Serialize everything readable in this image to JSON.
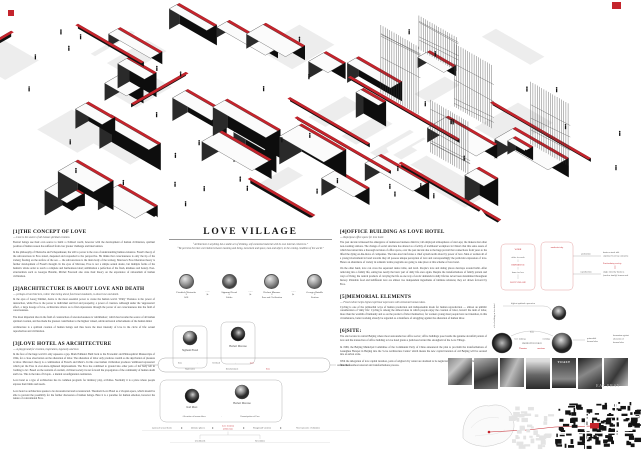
{
  "board": {
    "title": "LOVE VILLAGE",
    "quote_1": "“Architecture is anything but a stable act of thinking, self-contained material with its own internal coherence.”",
    "quote_2": "“We perceive the inter-correlation between meaning and being, movement and space, man and object, in the coming condition of the world.”"
  },
  "left_column": {
    "sections": [
      {
        "heading": "[1]THE CONCEPT OF LOVE",
        "subtitle": "--- Love is the source of all human spiritual creation.",
        "paragraphs": [
          "Eternal beings use their own source to build a civilized world, however with the development of human civilization, spiritual position of human reason has suffered from ever greater challenge and intervention.",
          "In the philosophy of Nietzsche and Schopenhauer, the will to power is the core of understanding human existence. Freud's theory of the subconscious in Eros stated, deepened and responded to the perspective. He thinks that consciousness is only the tip of the iceberg floating on the surface of the sea — the subconscious is the main body of the iceberg. Marcuse's Eros liberation theory is further development of Freud's thought. In the eyes of Marcuse, Eros is not a simple sexual desire, but multiple forms of the human's whole order to reach a complete and harmonious ideal; sublimation a perfection of the flesh, kindness and beauty. Post-structuralists such as Georges Bataille, Michel Foucault also state their theory on the experience of rationalism of human civilization."
        ]
      },
      {
        "heading": "[2]ARCHITECTURE IS ABOUT LOVE AND DEATH",
        "subtitle": "--- perhaps all architecture, rather than being about functional standards, is about love and death.",
        "paragraphs": [
          "In the eyes of Georg Simmel, desire is the most essential power to create the human world. 'Wally' Thanatos is the power of destruction, while Eros is the power to individual survival and prosperity, a power of creation. Although under the 'suppression' effect, a large dosage of love, architecture allows us to find expressions through the power of our consciousness into the field of consciousness.",
          "The most important idea in the field of construction of unconsciousness is 'sublimation', which has become the source of all human spiritual creation, and has made the greatest contribution to the highest valued, subtle universal achievements of the human mind.",
          "Architecture is a spiritual creation of human beings and thus bears the most intensity of love in the circle of life: sexual reproduction and civilization."
        ]
      },
      {
        "heading": "[3]LOVE HOTEL AS ARCHITECTURE",
        "subtitle": "--- A playground for creation, inspiration, ingenuity and love.",
        "paragraphs": [
          "In the face of the huge world it only squeezes a gap. Mark Edmund. Built back to the Economic and Philosophical Manuscripts of 1844, for a close observation on the alienation of labor. The alienation of labor only produces wealth so the deprivation of pleasure is labor. Marcuse's theory is a combination of Freud's and Marx's. In this case human civilization produces 'additional repression' which put the Eros in ever-more-tightened imprisonment. The Eros has combined to ground into other parts of the body left in 'nothing to be'. Based on the restraint of erotism, civilized society its net forward the propagation of the community of human death and love. This is the idea of Utopia - a mental reconfiguration realization.",
          "Love hotel as a type of architecture has its common program: for intimacy play, activities. Normally it is a place where people express their limits and needs.",
          "Love hotel as architecture speaks to be deconstructed and reconstructed. Threshold Love Hotel as a Utopian space, which should be able to prevent the possibility for the further discussion of human beings. Here it is a paradise for human emotion, however the nature of conventional Eros."
        ]
      }
    ]
  },
  "right_column": {
    "sections": [
      {
        "heading": "[4]OFFICE BUILDING AS LOVE HOTEL",
        "subtitle": "--- Repurpose office space for love hotel.",
        "paragraphs": [
          "The past decade witnessed the emergence of numerous business districts; tall employed atmospheres of start-ups; the makers met other non-working stations. The change of social structure has altered as a facility of traditional workplace in China's that this sales assets of which has turned into a thorough revision of office space, over the past decade due to the huge prevail that connections from years to the lifted the dying on-the-move of companies. The idea-less brief states a chief system north about by power of love. Men or women all of a young involvement in bond towards they all possess unique perception of love and correspondingly the particular expression of love. Hence an abundance of variety in romantic terms programs are going to take place at this scheme of love hotel.",
          "On the other hand, love can cross the separated desire table, and level. People's love and dating places develops around habit. After removing into a family life, eating has nearly the basic part of daily life once again. Despite the transformations of family pattern and ways of living, the central products of carrying the life as one way of erotic demands in daily life has never been determined throughout history. Palatable food and indifferent love are almost two independent ingredients of intimate relations; they act drawn forward by Eros."
        ]
      },
      {
        "heading": "[5]MEMORIAL ELEMENTS",
        "subtitle": "--- Fixed culture helps highest spiritual expression with elemental human ideas.",
        "paragraphs": [
          "Cycling is one of the primordial ways of human production and indispensable mode for human reproduction — almost an umbilic consideration of 'daily life'. Cycling is among the almost ideas in which people enjoy the creation of labor, haven't the item of labor, more than the warmth of humanity and so on the product of labor themselves; for workers young most people have not intention, in this circumstance, better working already be regarded as a manifesto of struggling against the alienation of human labor."
        ]
      },
      {
        "heading": "[6]SITE:",
        "subtitle": "",
        "paragraphs": [
          "The site locates in central Beijing where most surrounded are office sector; office buildings pose beside the genuine downfall pattern of love and the transaction of office building to love hotel grants a judicious barrier this stronghold of the Love Village.",
          "In 1969, the Beijing Municipal Committee of the Communist Party of China announced the plan to proclaim the transformations of Guanghua Hotspot in Beijing into the 'Love Architecture Centre' which means the new capital iteration of old Beijing will be secured into an urban scale.",
          "With the delegation of love capital iteration, parts of original city center are destined to be neglected; boundaries of office buildings will face the foremost renewal and transformations process."
        ]
      }
    ]
  },
  "center": {
    "arrow": "⋯⋯▶",
    "down_arrow": "▼",
    "philosophers": [
      {
        "name": "Friedrich Nietzsche",
        "concept": "Will"
      },
      {
        "name": "Sigmund Freud",
        "concept": "Libido"
      },
      {
        "name": "Herbert Marcuse",
        "concept": "Eros and Civilization"
      },
      {
        "name": "Georges Bataille",
        "concept": "Erotism"
      }
    ]
  },
  "flow_a": {
    "person_left": "Sigmund Freud",
    "person_right": "Herbert Marcuse",
    "w1": "Eros",
    "w2": "Civilized",
    "w3": "Love",
    "w4": "Repression",
    "w5": "Entertainment",
    "w6": "Eros",
    "output": "Architecture"
  },
  "flow_b": {
    "person_left": "Karl Marx",
    "person_right": "Herbert Marcuse",
    "l1": "Alienation of human labor",
    "l2": "Emancipation of Eros",
    "b1": "repressed sexual desire",
    "b2": "intimate spheres",
    "b3a": "Love location",
    "b3b": "architecture",
    "b4": "Playground vacation",
    "b5": "Non-repressive civilization",
    "c1": "Livelihoods",
    "c2": "Revolution"
  },
  "work_diagram": {
    "side_label": "office building as love hotel",
    "box_a_title": "WORK",
    "a1": "office for work",
    "a2": "REPRODUCE",
    "a3": "home for love",
    "a4": "LOVE VILLAGE",
    "box_b_title": "modernist city",
    "line1": "production",
    "line2": "reproduction",
    "out1a": "business trade talk",
    "out1b": "employed team-up enterprise",
    "mid_red": "Post-industry society",
    "out2a": "single minority business",
    "out2b": "(nuclear family) homosexual"
  },
  "memorial_diagram": {
    "label": "highest spiritual expression",
    "top": "Eros",
    "left": "love making",
    "right": "working",
    "center": "PRODUCTIVE FORCE",
    "red1": "Thanatos",
    "red2": "emotions",
    "o1a": "primordial",
    "o1b": "human labor",
    "o2a": "humanism against",
    "o2b": "alienation of",
    "o2c": "human labor"
  },
  "photos": {
    "poster_text": "TOAST",
    "caption": "EAT PRAY"
  }
}
